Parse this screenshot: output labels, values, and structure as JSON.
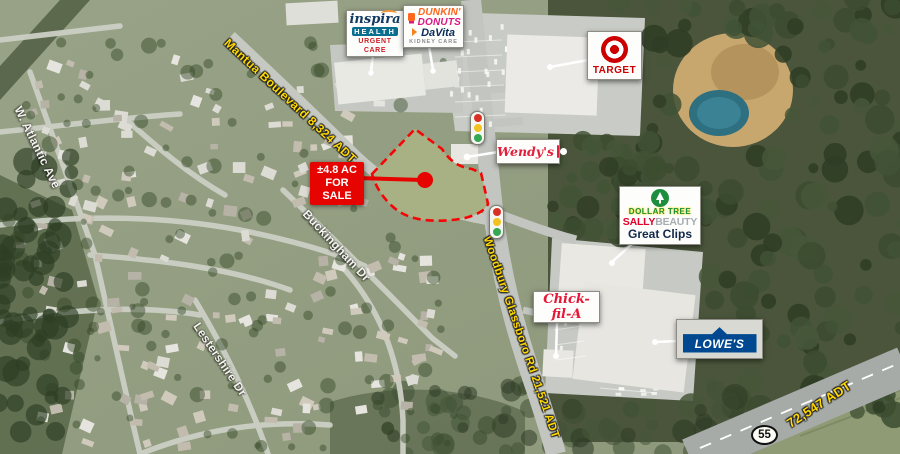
{
  "parcel_callout": {
    "line1": "±4.8 AC",
    "line2": "FOR SALE"
  },
  "road_labels": {
    "mantua": "Mantua Boulevard 8,324 ADT",
    "woodbury": "Woodbury Glassboro Rd 21,521 ADT",
    "route55_adt": "72,547 ADT",
    "route55_shield": "55",
    "atlantic": "W. Atlantic Ave",
    "buckingham": "Buckingham Dr",
    "lestershire": "Lestershire Dr"
  },
  "retailers": {
    "inspira": {
      "name": "inspira",
      "division": "HEALTH",
      "tagline": "URGENT CARE"
    },
    "dunkin": {
      "line1": "DUNKIN'",
      "line2": "DONUTS"
    },
    "davita": {
      "name": "DaVita",
      "tagline": "KIDNEY CARE"
    },
    "target": {
      "name": "TARGET"
    },
    "wendys": {
      "name": "Wendy's"
    },
    "dollar_tree": {
      "name": "DOLLAR TREE"
    },
    "sally_beauty": {
      "word1": "SALLY",
      "word2": "BEAUTY"
    },
    "great_clips": {
      "name": "Great Clips"
    },
    "chick_fil_a": {
      "name": "Chick-fil-A"
    },
    "lowes": {
      "name": "LOWE'S"
    }
  },
  "colors": {
    "sale_red": "#e50400",
    "parcel_dash_red": "#f50505",
    "label_yellow": "#ffd800",
    "street_label_white": "#f4f4ee",
    "target_red": "#cc0000",
    "dunkin_orange": "#ff671f",
    "dunkin_pink": "#da1884",
    "davita_navy": "#0b2d5c",
    "inspira_navy": "#123a63",
    "inspira_teal": "#0a6f8f",
    "urgent_care_red": "#cc2027",
    "wendys_red": "#e2203d",
    "dollar_tree_green": "#1e8e3e",
    "sally_red": "#e4002b",
    "great_clips_navy": "#12284b",
    "chick_fil_a_red": "#e51636",
    "lowes_blue": "#004990"
  }
}
